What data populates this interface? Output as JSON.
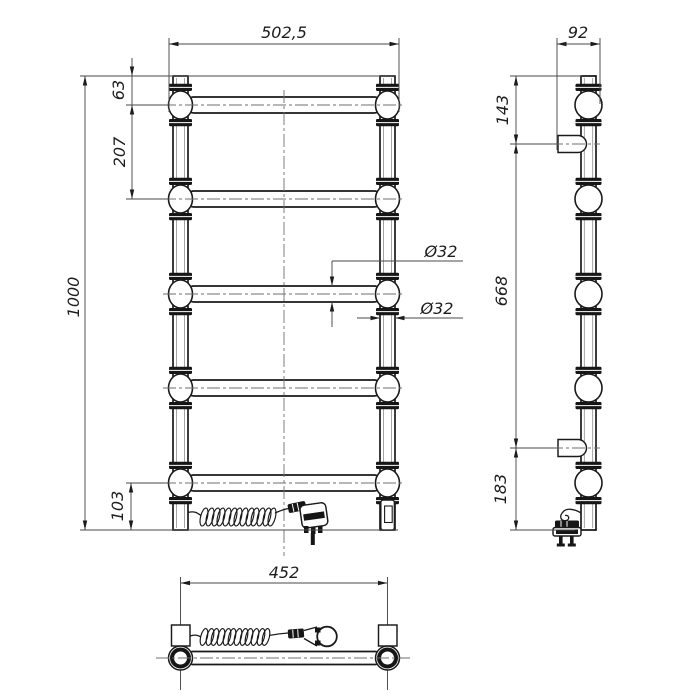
{
  "app": {
    "type": "technical-drawing",
    "subject": "electric heated towel rail, three-view dimensioned drawing"
  },
  "colors": {
    "background": "#ffffff",
    "object_line": "#1a1a1a",
    "dimension_line": "#4a4a4a",
    "centerline": "#6f6f6f"
  },
  "views": {
    "front": {
      "label": "front view",
      "dims": {
        "overall_width": "502,5",
        "overall_height": "1000",
        "top_to_first_bar": "63",
        "bar_pitch": "207",
        "last_bar_to_bottom": "103",
        "crossbar_diameter": "Ø32",
        "post_diameter": "Ø32"
      }
    },
    "side": {
      "label": "side view",
      "dims": {
        "overall_depth": "92",
        "top_to_upper_bracket": "143",
        "bracket_spacing": "668",
        "lower_bracket_to_bottom": "183"
      }
    },
    "bottom": {
      "label": "bottom view",
      "dims": {
        "bracket_mount_width": "452"
      }
    }
  }
}
